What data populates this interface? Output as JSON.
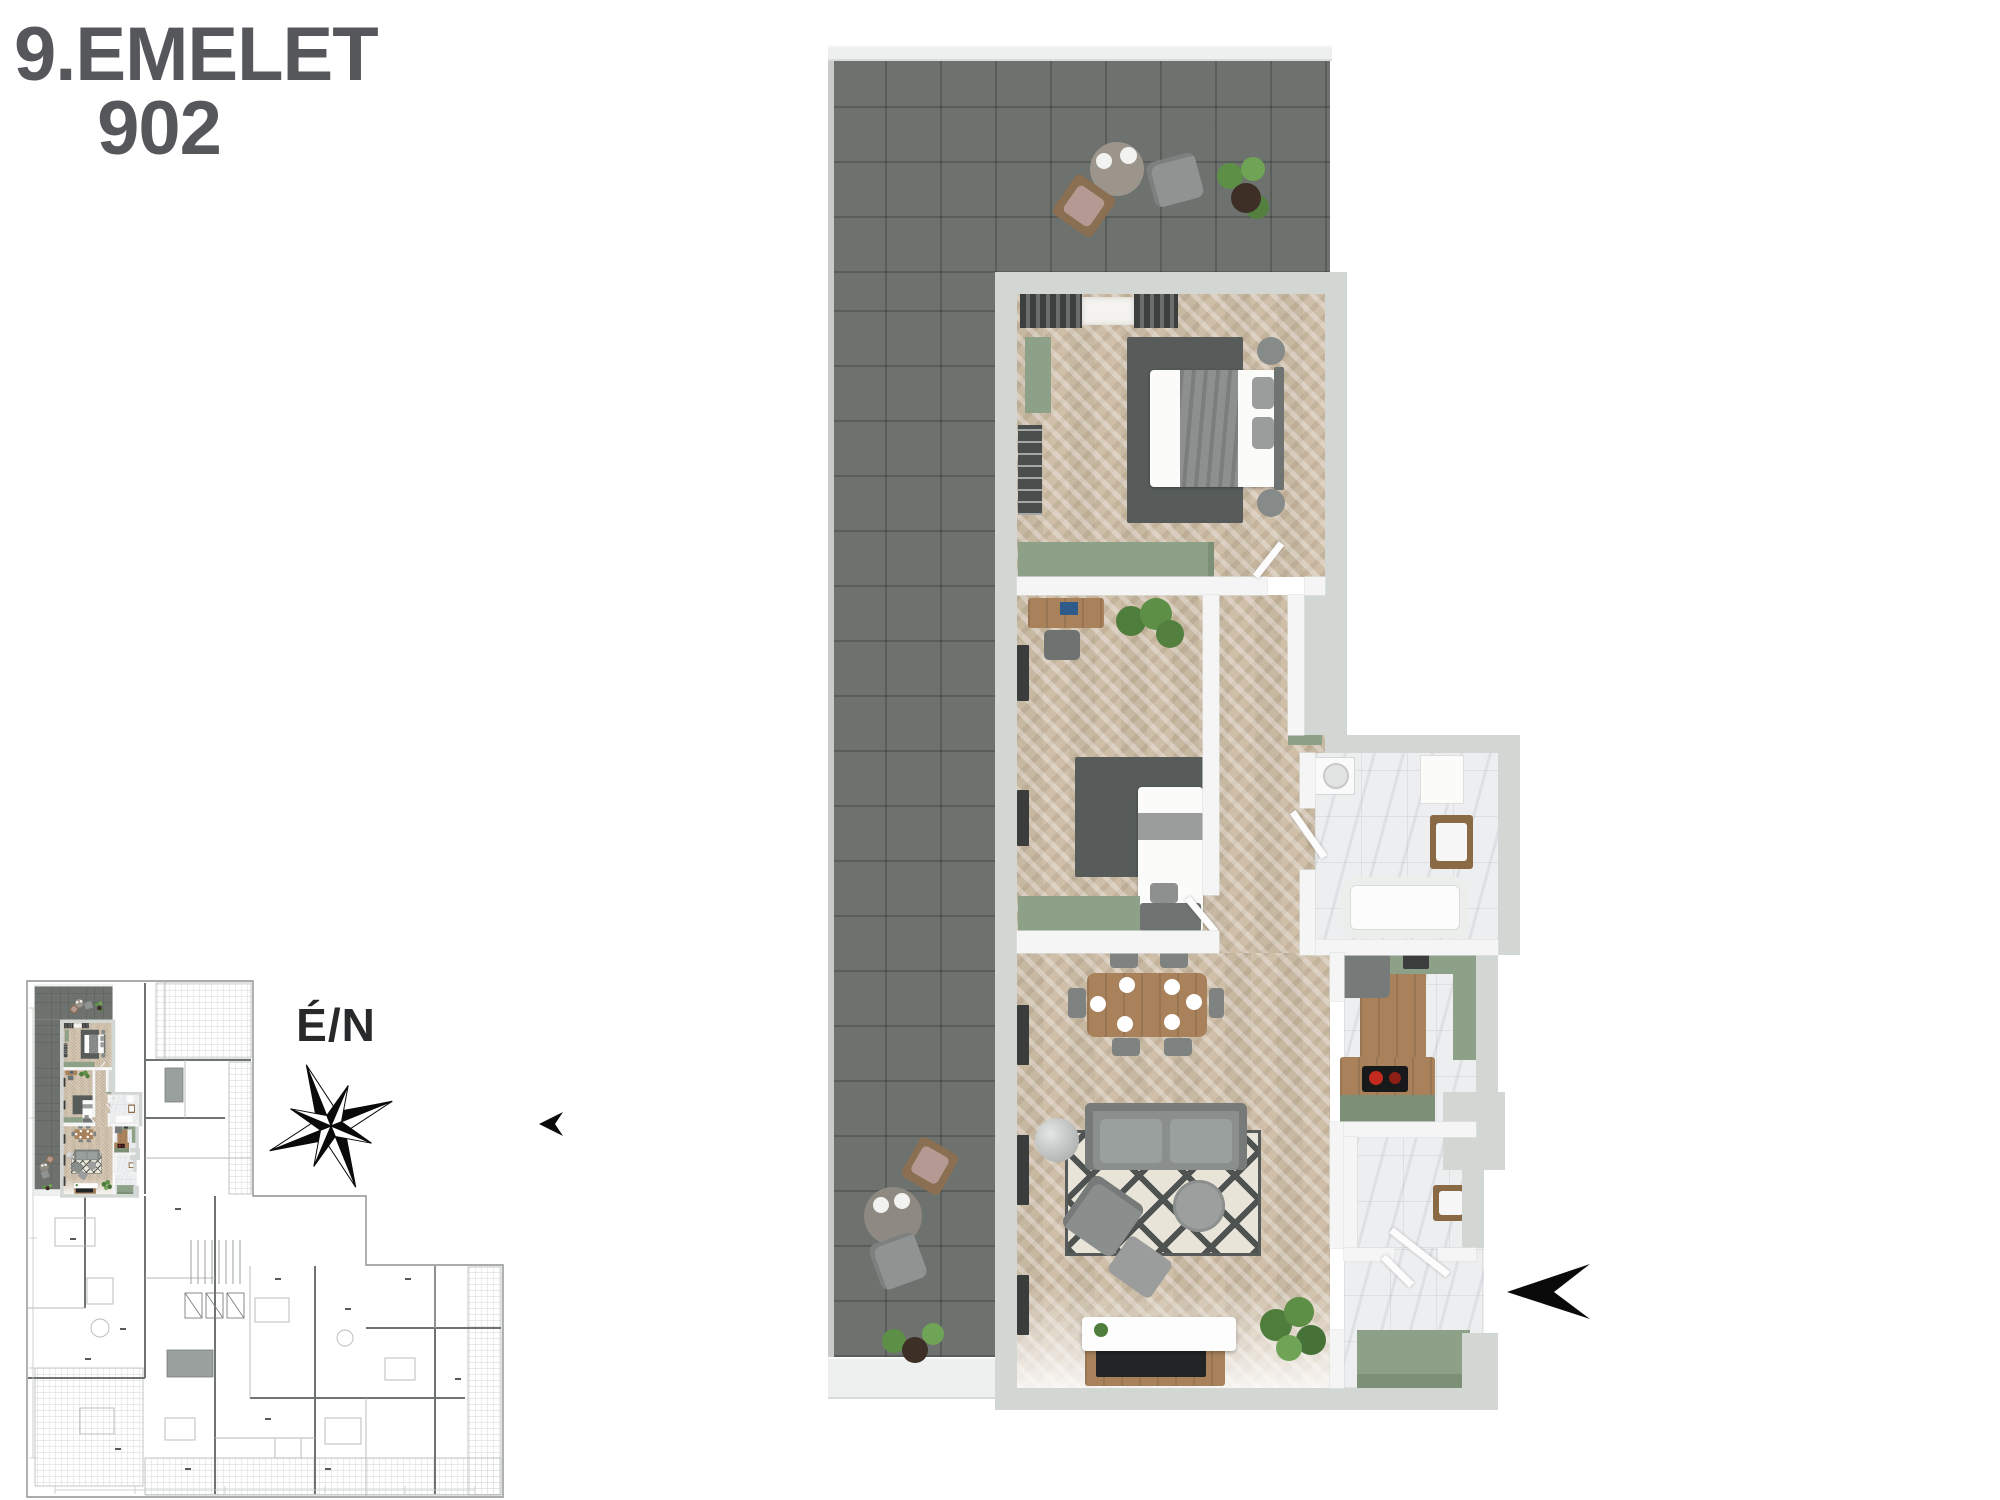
{
  "title": {
    "floor_label": "9.EMELET",
    "unit_number": "902"
  },
  "compass": {
    "label": "É/N"
  },
  "palette": {
    "title_text": "#56575a",
    "terrace_tile": "#6d726e",
    "outer_wall": "#d3d7d4",
    "inner_wall": "#f4f5f4",
    "wood_floor": "#cfbfa9",
    "marble_floor": "#edeef0",
    "sage_accent": "#8da189",
    "dark_rug": "#575c5a",
    "furniture_wood": "#a9825c",
    "arrow_black": "#0a0a0a"
  },
  "icons": {
    "compass_rose": "compass-rose-icon",
    "entrance_arrow": "entrance-arrow-icon"
  }
}
